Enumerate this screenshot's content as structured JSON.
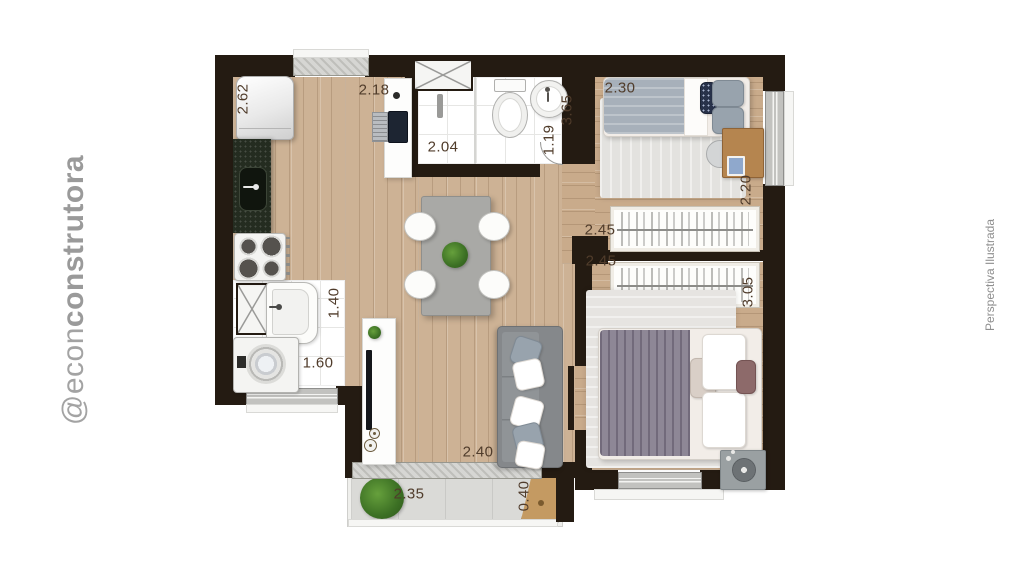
{
  "watermark": {
    "prefix": "@econ",
    "suffix": "construtora"
  },
  "side_note": "Perspectiva Ilustrada",
  "dimensions": {
    "kitchen_depth": "2.62",
    "kitchen_width": "2.18",
    "bath_width": "2.04",
    "bath_depth": "1.19",
    "bedroom2_width": "2.30",
    "bedroom2_depth": "2.20",
    "living_depth": "3.65",
    "hall_width_top": "2.45",
    "hall_width_bottom": "2.45",
    "bedroom1_depth": "3.05",
    "laundry_depth": "1.40",
    "laundry_width": "1.60",
    "living_width": "2.40",
    "balcony_width": "2.35",
    "balcony_depth": "0.40"
  },
  "colors": {
    "wall": "#241b12",
    "wood_living": "#cdb295",
    "wood_bedroom": "#c9ab8b",
    "dimension_text": "#503c2b",
    "watermark_gray": "#a3a3a3",
    "granite": "#242c20",
    "sofa_gray": "#85888b",
    "plant_green": "#3c7024"
  }
}
